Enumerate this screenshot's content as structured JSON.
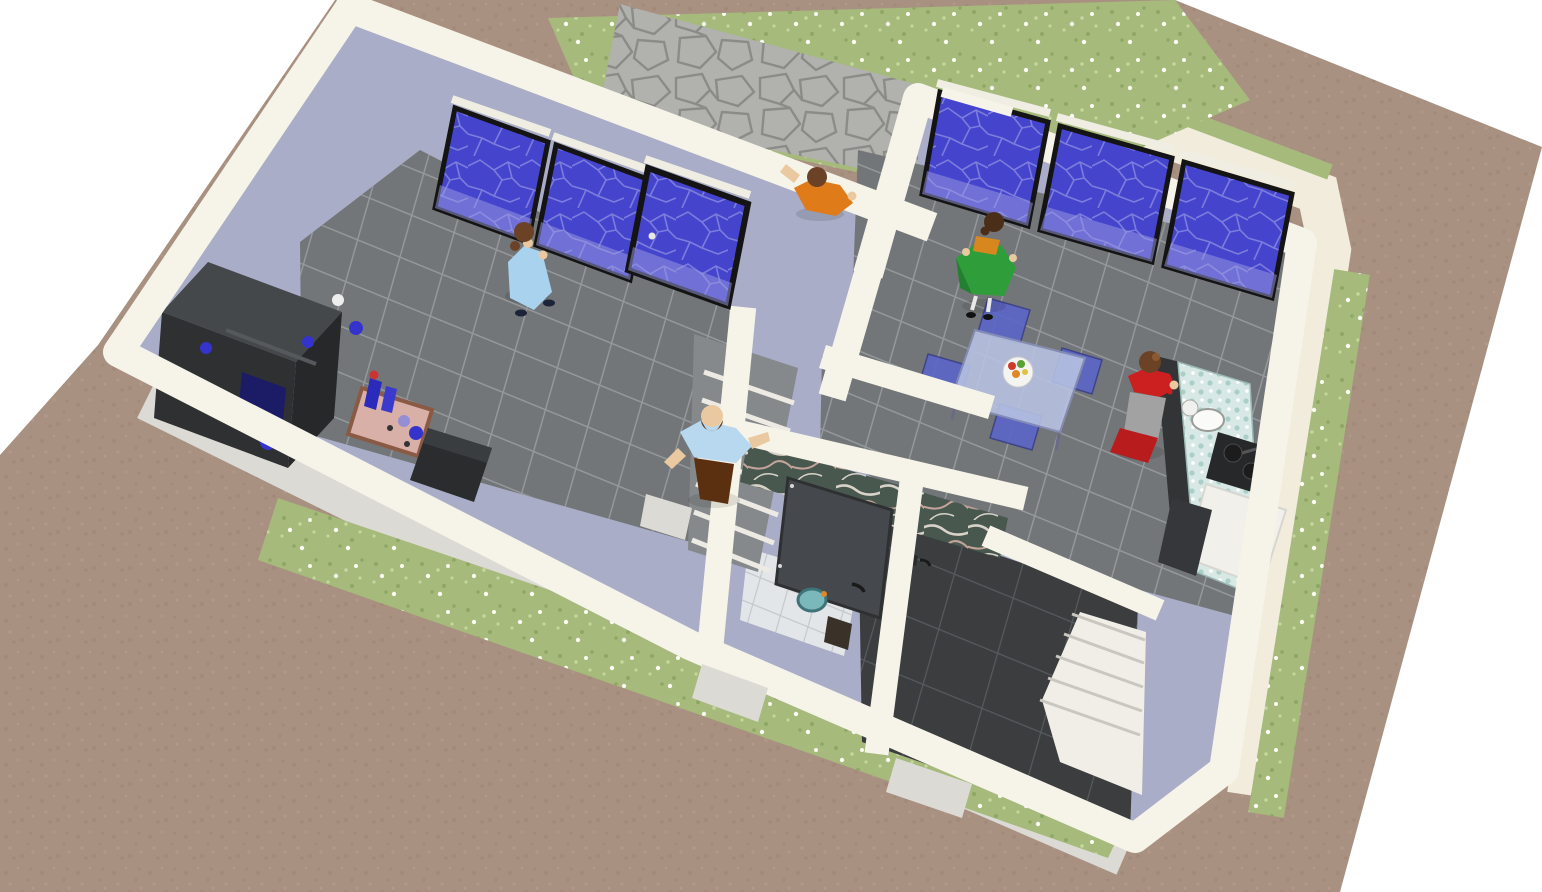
{
  "scene": {
    "title": "Aerial dollhouse view of a one-story house with five occupants",
    "view": "oblique top-down 3D cutaway, roof removed, rotated ~20 degrees",
    "environment": {
      "ground": "brown dirt lot",
      "lawn": "grass strips dotted with small white flowers",
      "patio": "gray flagstone terrace at the top-left of the house"
    }
  },
  "palette": {
    "bg": "#ffffff",
    "terrain": "#a99181",
    "terrainSpeck": "#9c8472",
    "terrainSpeckLight": "#b59d8c",
    "grass": "#a5ba7b",
    "grassDark": "#8fa765",
    "grassLight": "#c6d79e",
    "flower": "#fbfbf3",
    "patioStone": "#b1b1ad",
    "patioJoint": "#8b8b87",
    "wallTop": "#f6f3e8",
    "wallInterior": "#a9adc7",
    "wallExterior": "#dcdad4",
    "walkway": "#f1ecdc",
    "doorSill": "#dcdad4",
    "floorTile": "#737678",
    "floorGrout": "#95989b",
    "darkFloor": "#3b3d3f",
    "darkFloorGrout": "#585b5d",
    "bathFloor": "#e3e6e9",
    "bathGrout": "#c4c8ca",
    "stairBase": "#86898b",
    "stairEdge": "#eceae2",
    "stairWhite": "#f0eee6",
    "stairLine": "#c9c7bf",
    "glass": "#4444cd",
    "glassWeb": "#7c7cdd",
    "glassReflect": "#9b9be2",
    "frame": "#141414",
    "frameLight": "#f0ede2",
    "marble": "#48584f",
    "marbleVein": "#d8d2c8",
    "marbleVeinPink": "#c4a49a",
    "door": "#45484c",
    "doorEdge": "#2e3032",
    "unitDark": "#26282a",
    "unitMid": "#2e3032",
    "unitTop": "#45484b",
    "accentBlue": "#3434cc",
    "screenBlue": "#1c1c66",
    "knobWhite": "#eeeeee",
    "tableTop": "#d8b0a8",
    "tableEdge": "#8a5a44",
    "bottleBlue": "#2a2abb",
    "capRed": "#cc3333",
    "sofa": "#2a2c2e",
    "sofaHi": "#3a3d40",
    "tableGlass": "#b9c4e4",
    "tableLeg": "#6a6a8a",
    "chairBlue": "#5b66c8",
    "chairEdge": "#3a3f8a",
    "plate": "#f4f4f2",
    "counterMosaic": "#d8e9e5",
    "counterSpeck": "#abcfc8",
    "counterDark": "#323436",
    "applianceWhite": "#f2f0ea",
    "applianceEdge": "#d8d6d0",
    "stoveDark": "#26282a",
    "panBlack": "#1c1c1c",
    "sinkWhite": "#fafaf8",
    "bathSink": "#7ab8bc",
    "bathCounter": "#e6e4b8",
    "binDark": "#3a3228",
    "skin": "#eac9a0",
    "hairBrown": "#6b4226",
    "hairDark": "#4a2e18",
    "shadow": "#000000",
    "dressBlue": "#a8d2ee",
    "shoeDark": "#1e2438",
    "shirtOrange": "#e07b1a",
    "shirtBlue": "#b8d8f0",
    "pantsBrown": "#5a3010",
    "skirtGreen": "#2f9e3a",
    "skirtGreenDark": "#238030",
    "topOrange": "#d8861e",
    "stocking": "#e8e8e8",
    "shoeBlack": "#111111",
    "topRed": "#cc2020",
    "apronGray": "#a2a2a2",
    "skirtRed": "#b81c1c",
    "fruitRed": "#d03a2a",
    "fruitGreen": "#5aa032",
    "fruitOrange": "#e08828",
    "fruitYellow": "#e0c040"
  },
  "rooms": [
    {
      "id": "living-room",
      "name": "Living room",
      "floor": "gray ceramic tile",
      "contents": "entertainment wall unit, coffee table with bottles, dark sofa"
    },
    {
      "id": "hallway-stairs",
      "name": "Hallway with staircase",
      "floor": "gray tile steps descending",
      "contents": "staircase, balding man walking"
    },
    {
      "id": "closet",
      "name": "Small closet/pantry",
      "floor": "gray tile",
      "contents": ""
    },
    {
      "id": "bathroom",
      "name": "Bathroom",
      "floor": "white tile",
      "contents": "green marble wall, gray door ajar, round teal basin, waste bin"
    },
    {
      "id": "dining-kitchen",
      "name": "Dining room and kitchen",
      "floor": "gray tile",
      "contents": "glass dining table with blue chairs, fruit plate, mosaic kitchen counter with sink and stove"
    },
    {
      "id": "dark-room",
      "name": "Dark tiled room with stairwell",
      "floor": "charcoal tile",
      "contents": "white staircase in corner"
    },
    {
      "id": "patio",
      "name": "Flagstone patio",
      "floor": "gray flagstone",
      "contents": "man in orange shirt"
    }
  ],
  "people": [
    {
      "id": "woman-blue",
      "label": "Woman in light blue dress",
      "hair": "brown ponytail",
      "location": "living room, facing the sliding glass doors"
    },
    {
      "id": "man-orange",
      "label": "Man in orange shirt",
      "hair": "brown",
      "location": "outside on the flagstone patio, arm raised"
    },
    {
      "id": "man-blue",
      "label": "Balding man in light blue shirt and brown trousers",
      "hair": "brown fringe",
      "location": "hallway near the staircase"
    },
    {
      "id": "woman-green",
      "label": "Woman in green skirt and orange top",
      "hair": "dark brown bun",
      "location": "dining room, walking toward the windows"
    },
    {
      "id": "woman-red",
      "label": "Woman in red outfit with gray apron",
      "hair": "brown",
      "location": "kitchen, standing at the counter"
    }
  ],
  "furniture": [
    {
      "id": "wall-unit",
      "label": "Dark entertainment wall unit with blue screens"
    },
    {
      "id": "coffee-table",
      "label": "Small coffee table with blue bottles and glasses"
    },
    {
      "id": "sofa",
      "label": "Dark two-seat sofa"
    },
    {
      "id": "dining-table",
      "label": "Glass dining table with fruit plate"
    },
    {
      "id": "dining-chairs",
      "label": "Four translucent blue chairs"
    },
    {
      "id": "kitchen-counter",
      "label": "Mosaic kitchen counter with sink, stove and white cabinet"
    },
    {
      "id": "bathroom-sink",
      "label": "Round teal bathroom basin"
    },
    {
      "id": "bathroom-door",
      "label": "Gray bathroom door, ajar"
    },
    {
      "id": "hall-stairs",
      "label": "Staircase descending from hallway"
    },
    {
      "id": "corner-stairs",
      "label": "White corner staircase in dark room"
    }
  ],
  "windows": {
    "left_wing": {
      "count": 3,
      "type": "sliding glass doors, one panel slid open",
      "glass": "deep blue with crackle pattern"
    },
    "right_wing": {
      "count": 3,
      "type": "full-height windows, one ajar",
      "glass": "deep blue with crackle pattern"
    }
  }
}
